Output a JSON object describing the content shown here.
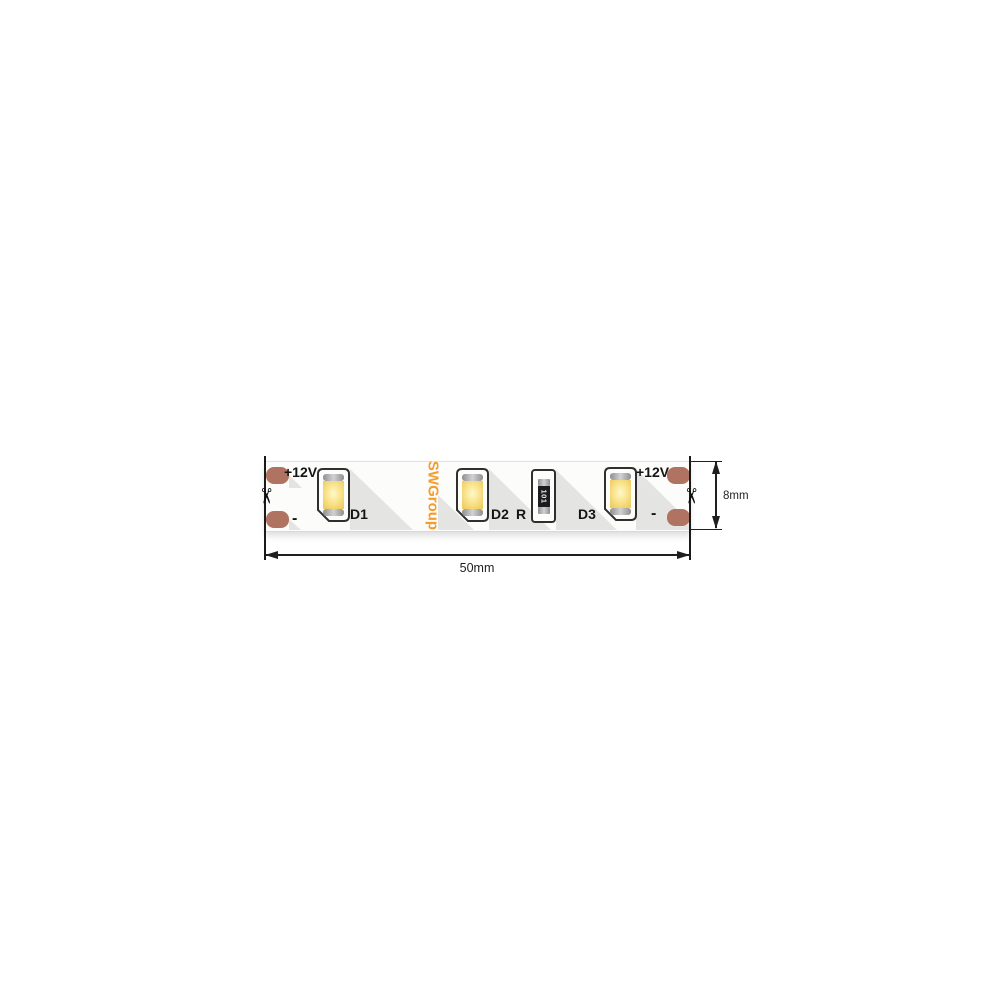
{
  "strip": {
    "brand": "SWGroup",
    "terminals": {
      "left_positive": "+12V",
      "left_negative": "-",
      "right_positive": "+12V",
      "right_negative": "-"
    },
    "components": {
      "led1": "D1",
      "led2": "D2",
      "led3": "D3",
      "resistor": "R",
      "resistor_code": "101"
    }
  },
  "dimensions": {
    "length": "50mm",
    "width": "8mm"
  },
  "icons": {
    "scissors": "✂"
  },
  "colors": {
    "copper_pad": "#B17361",
    "brand_orange": "#F49C2D",
    "led_phosphor": "#F3D467",
    "package_outline": "#2F2F2F",
    "shadow_gray": "#E4E4E2"
  }
}
